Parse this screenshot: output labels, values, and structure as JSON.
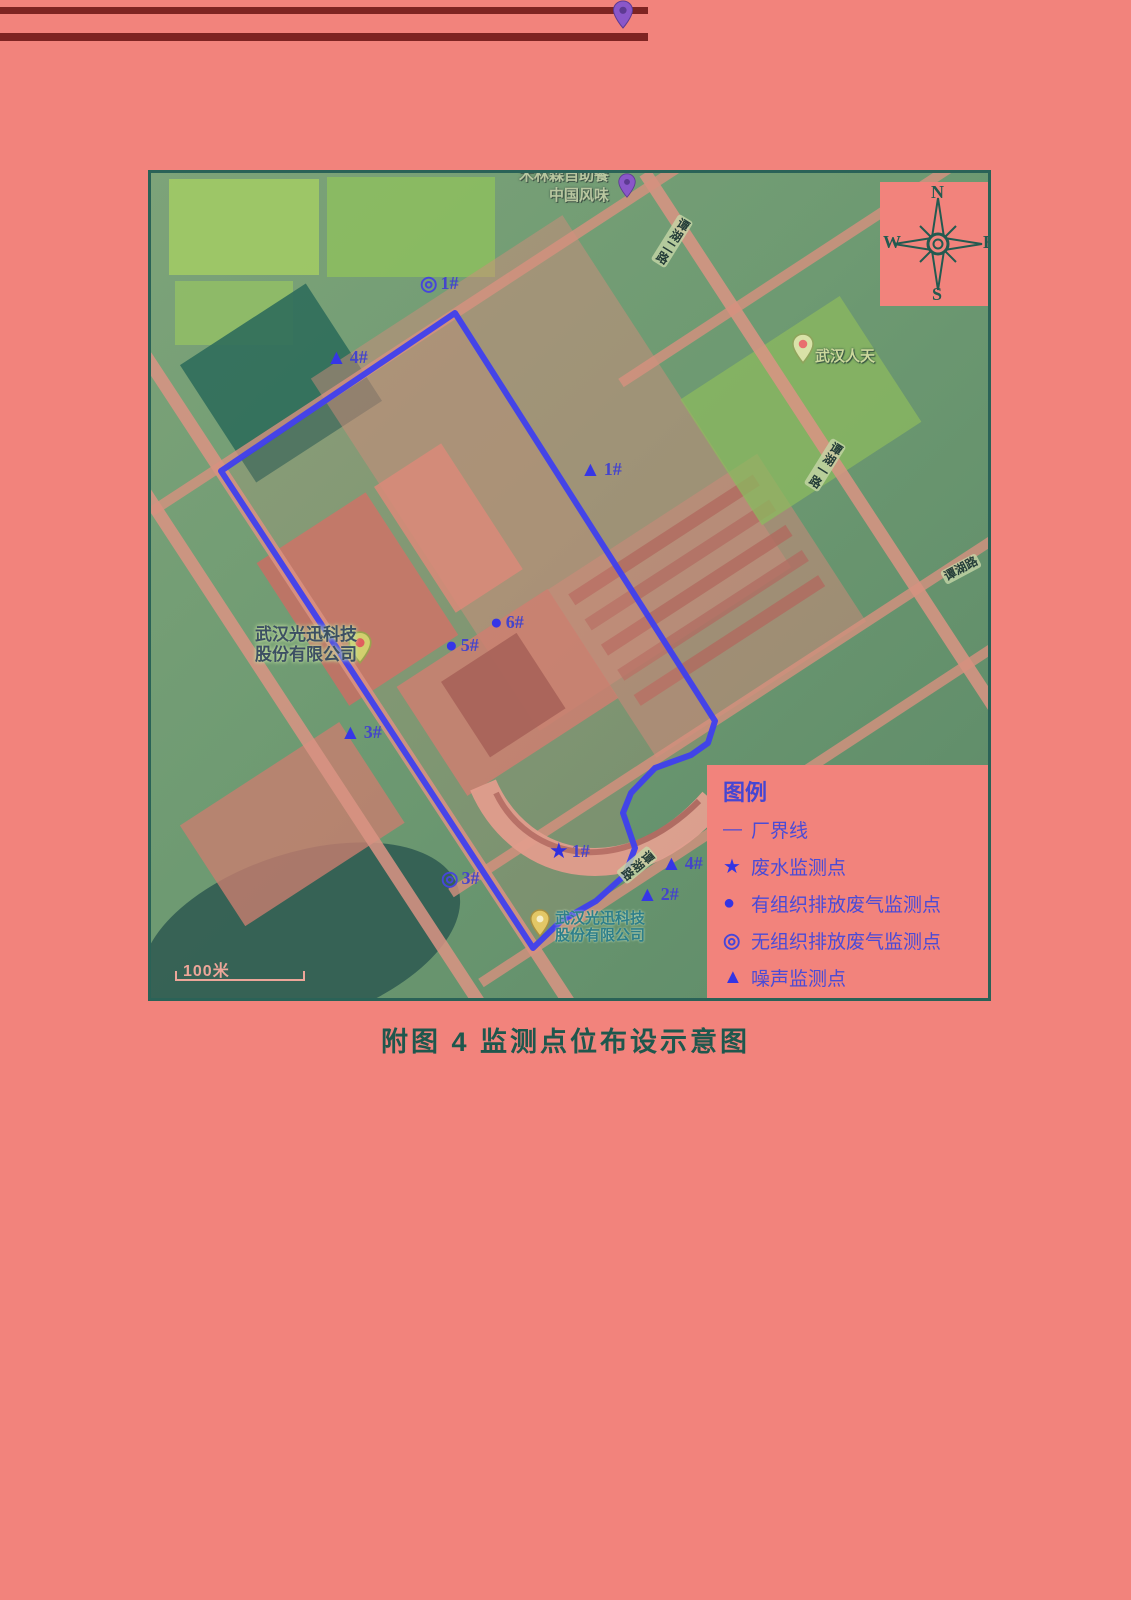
{
  "page": {
    "caption": "附图 4  监测点位布设示意图"
  },
  "colors": {
    "page_background": "#f2837c",
    "map_border": "#2a6257",
    "boundary_line": "#4040ee",
    "marker_blue": "#3636e6",
    "legend_text": "#4b4bd6",
    "caption_text": "#1f574d"
  },
  "compass": {
    "north": "N",
    "south": "S",
    "east": "E",
    "west": "W"
  },
  "legend": {
    "title": "图例",
    "items": [
      {
        "type": "line",
        "symbol": "—",
        "label": "厂界线"
      },
      {
        "type": "star",
        "symbol": "★",
        "label": "废水监测点"
      },
      {
        "type": "dot",
        "symbol": "●",
        "label": "有组织排放废气监测点"
      },
      {
        "type": "ring",
        "symbol": "◎",
        "label": "无组织排放废气监测点"
      },
      {
        "type": "triangle",
        "symbol": "▲",
        "label": "噪声监测点"
      }
    ]
  },
  "map": {
    "scale_label": "100米",
    "markers": [
      {
        "type": "ring",
        "symbol": "◎",
        "label": "1#",
        "x": 280,
        "y": 113
      },
      {
        "type": "triangle",
        "symbol": "▲",
        "label": "4#",
        "x": 186,
        "y": 187
      },
      {
        "type": "triangle",
        "symbol": "▲",
        "label": "1#",
        "x": 440,
        "y": 299
      },
      {
        "type": "dot",
        "symbol": "●",
        "label": "6#",
        "x": 350,
        "y": 452
      },
      {
        "type": "dot",
        "symbol": "●",
        "label": "5#",
        "x": 305,
        "y": 475
      },
      {
        "type": "triangle",
        "symbol": "▲",
        "label": "3#",
        "x": 200,
        "y": 562
      },
      {
        "type": "star",
        "symbol": "★",
        "label": "1#",
        "x": 409,
        "y": 680
      },
      {
        "type": "ring",
        "symbol": "◎",
        "label": "3#",
        "x": 301,
        "y": 708
      },
      {
        "type": "triangle",
        "symbol": "▲",
        "label": "4#",
        "x": 521,
        "y": 693
      },
      {
        "type": "triangle",
        "symbol": "▲",
        "label": "2#",
        "x": 497,
        "y": 724
      }
    ],
    "road_labels": [
      {
        "text": "谭湖二路",
        "x": 521,
        "y": 68,
        "rot": 32,
        "vertical": true
      },
      {
        "text": "谭湖一路",
        "x": 674,
        "y": 292,
        "rot": 32,
        "vertical": true
      },
      {
        "text": "谭湖路",
        "x": 810,
        "y": 396,
        "rot": -28,
        "vertical": false
      },
      {
        "text": "谭湖路",
        "x": 486,
        "y": 692,
        "rot": 50,
        "vertical": true
      }
    ],
    "pois": {
      "rentian": {
        "label": "武汉人天"
      },
      "accelink_west": {
        "line1": "武汉光迅科技",
        "line2": "股份有限公司"
      },
      "accelink_south": {
        "line1": "武汉光迅科技",
        "line2": "股份有限公司"
      },
      "restaurant": {
        "line1": "木林森自助餐",
        "line2": "中国风味"
      }
    }
  }
}
